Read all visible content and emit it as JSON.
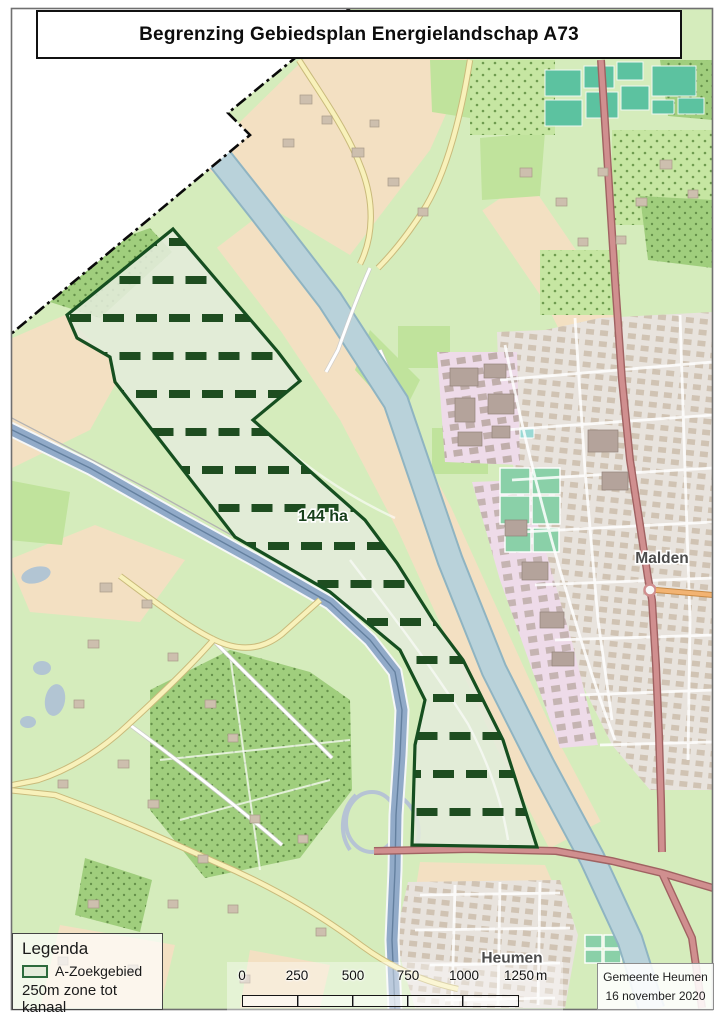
{
  "title": "Begrenzing Gebiedsplan Energielandschap A73",
  "map": {
    "area_label": "144 ha",
    "towns": {
      "malden": "Malden",
      "heumen": "Heumen"
    }
  },
  "legend": {
    "title": "Legenda",
    "items": [
      {
        "label": "A-Zoekgebied"
      }
    ],
    "note": "250m zone tot kanaal"
  },
  "scalebar": {
    "ticks": [
      "0",
      "250",
      "500",
      "750",
      "1000",
      "1250"
    ],
    "unit": "m"
  },
  "attribution": {
    "line1": "Gemeente Heumen",
    "line2": "16 november 2020"
  },
  "palette": {
    "zone-fill": "#e4ecdb",
    "zone-border": "#164f20",
    "zone-hatch": "#1e4d20",
    "legend-swatch-border": "#2c6b3d",
    "canal": "#b9d2da",
    "canal-edge": "#8fb4c2",
    "motorway": "#91aac8",
    "road-primary": "#d08f8f",
    "road-primary-casing": "#a06262",
    "road-orange": "#f2b372",
    "road-yellow": "#f8f1ba",
    "road-yellow-casing": "#c9ba7b",
    "farmland": "#f3e0c2",
    "grass": "#d5ecbc",
    "grass2": "#c0e39c",
    "forest": "#a0ce7d",
    "forest-dot": "#65914a",
    "orchard": "#c6e6a2",
    "orchard-dot": "#6f9b50",
    "urban": "#e8e3dd",
    "building": "#cdbfae",
    "building-dark": "#b4a39b",
    "industrial": "#eedbe9",
    "greenhouse": "#5cc2a0",
    "sport": "#8ad0a8",
    "water": "#b2c5d3",
    "boundary": "#0a0a0a"
  }
}
